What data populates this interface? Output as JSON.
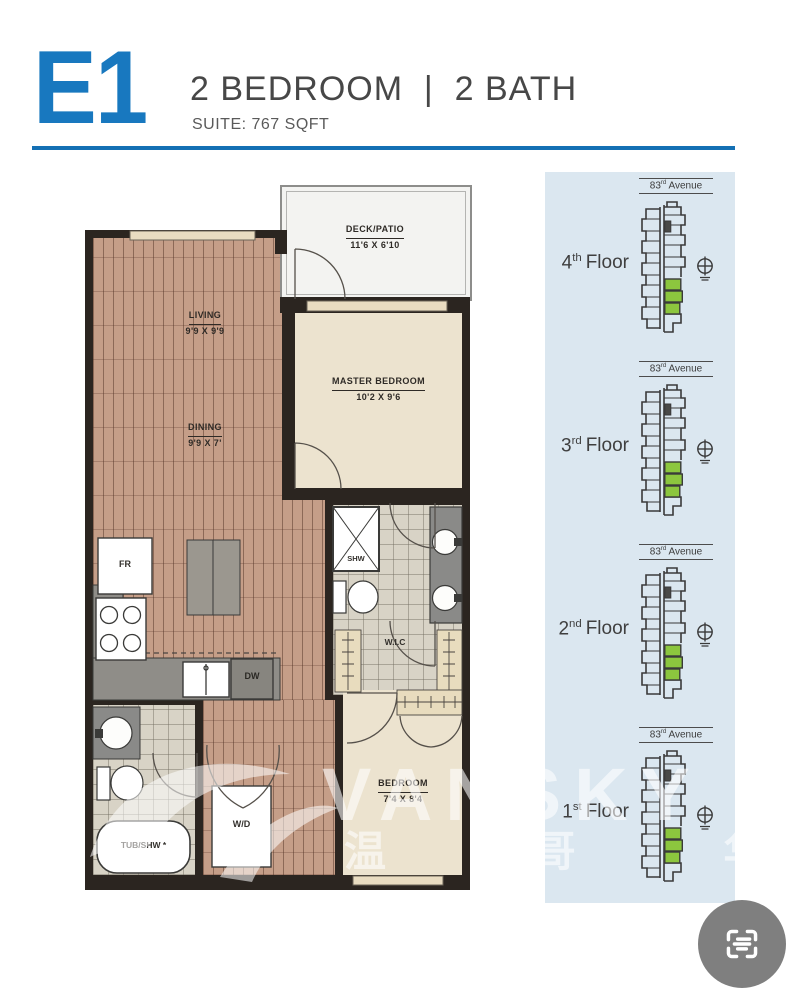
{
  "header": {
    "plan_code": "E1",
    "title": "2 BEDROOM  |  2 BATH",
    "suite": "SUITE: 767 SQFT"
  },
  "floorplan": {
    "deck": {
      "name": "DECK/PATIO",
      "dims": "11'6 X 6'10"
    },
    "living": {
      "name": "LIVING",
      "dims": "9'9 X 9'9"
    },
    "dining": {
      "name": "DINING",
      "dims": "9'9 X 7'"
    },
    "master": {
      "name": "MASTER BEDROOM",
      "dims": "10'2 X 9'6"
    },
    "bedroom": {
      "name": "BEDROOM",
      "dims": "7'4 X 8'4"
    },
    "wic_label": "W.I.C",
    "fixtures": {
      "fridge": "FR",
      "dishwasher": "DW",
      "shower": "SHW",
      "tub": "TUB/SHW *",
      "washer_dryer": "W/D"
    }
  },
  "sidebar": {
    "avenue": {
      "num": "83",
      "ord": "rd",
      "word": "Avenue"
    },
    "floors": [
      {
        "num": "4",
        "ord": "th",
        "word": "Floor"
      },
      {
        "num": "3",
        "ord": "rd",
        "word": "Floor"
      },
      {
        "num": "2",
        "ord": "nd",
        "word": "Floor"
      },
      {
        "num": "1",
        "ord": "st",
        "word": "Floor"
      }
    ],
    "panel_bg": "#dbe7f0",
    "unit_highlight_color": "#8cc63e"
  },
  "watermark": {
    "latin": "VANSKY",
    "cjk": "温 哥 华"
  },
  "colors": {
    "accent_blue": "#1878bf",
    "wall": "#2b2520",
    "wood_floor": "#c59e88",
    "room_cream": "#ece3cf",
    "tile": "#d8d3c6",
    "counter_gray": "#8f8d88",
    "highlight_green": "#8cc63e"
  }
}
